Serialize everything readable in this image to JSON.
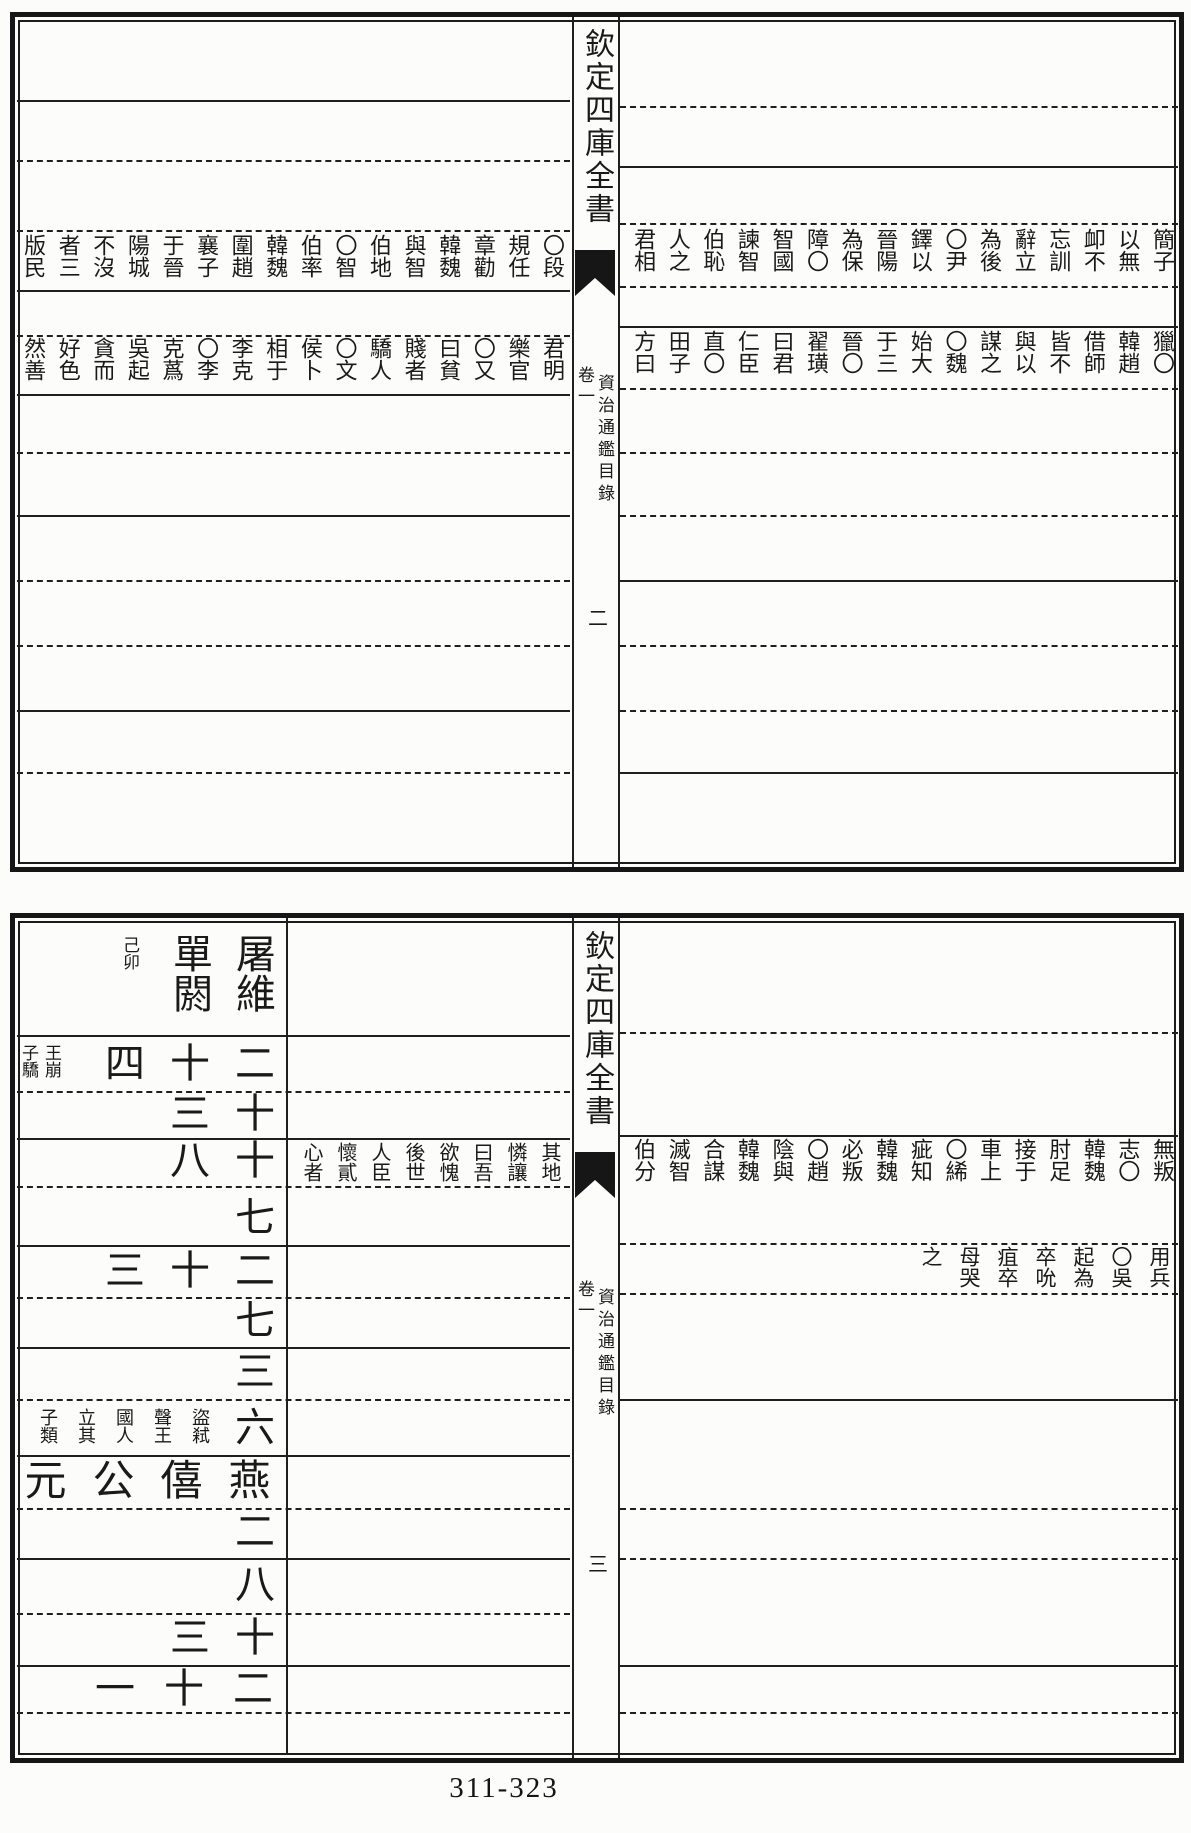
{
  "page_footer": "311-323",
  "spine": {
    "banner": "欽定四庫全書",
    "volume": "卷一",
    "title": "資治通鑑目錄",
    "page_top": "二",
    "page_bottom": "三"
  },
  "top_block": {
    "right_page": {
      "row1": "簡子以無卹不忘訓辭立為後〇尹鐸以晉陽為保障〇智國諫智伯恥人之君相",
      "row2": "獵〇韓趙借師皆不與以謀之〇魏始大于三晉〇翟璜曰君仁臣直〇田子方曰"
    },
    "left_page": {
      "row1": "〇段規任章勸韓魏與智伯地〇智伯率韓魏圍趙襄子于晉陽城不沒者三版民",
      "row2": "君明樂官〇又曰貧賤者驕人〇文侯卜相于李克〇李克蔿吳起貪而好色然善"
    }
  },
  "bottom_block": {
    "right_page": {
      "row1": "無叛志〇韓魏肘足接于車上〇絺疵知韓魏必叛〇趙陰與韓魏合謀滅智伯分",
      "row2": "用兵〇吳起為卒吮疽卒母哭之"
    },
    "left_page": {
      "year_row1": "屠維單閼",
      "note_row1": "己卯",
      "count_row2": "二十四",
      "note_row2": "王崩子驕",
      "count_row3": "十三",
      "count_row4": "十八",
      "text_row4": "其地憐讓曰吾欲愧後世人臣懷貳心者",
      "count_row5": "七",
      "count_row6": "二十三",
      "count_row7": "七",
      "count_row8": "三",
      "count_row9": "六",
      "note_row9": "盜弒聲王國人立其子類",
      "year_row10": "燕僖公元",
      "count_row11": "二",
      "count_row12": "八",
      "count_row13": "十三",
      "count_row14": "二十一"
    }
  }
}
